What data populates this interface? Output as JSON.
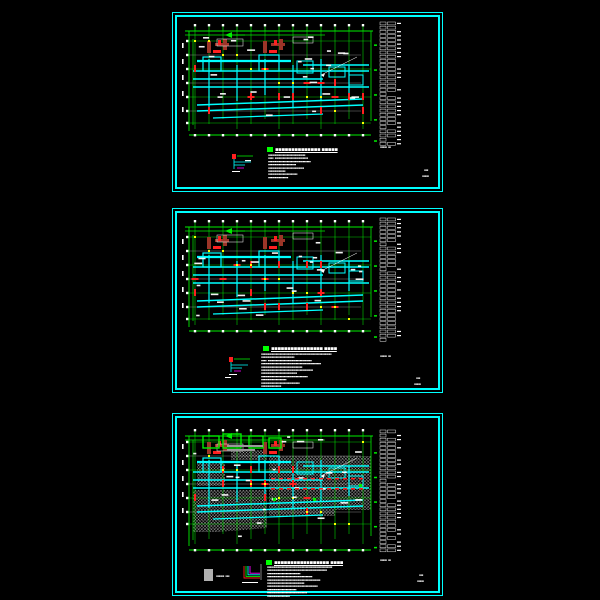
{
  "app": {
    "background": "#000000",
    "description": "cad-drawing-preview-three-sheets"
  },
  "colors": {
    "border": "#00ffff",
    "grid_green": "#00ee00",
    "beam_cyan": "#00ffff",
    "column_red": "#ff2020",
    "column_dark": "#9c3528",
    "node_yellow": "#ffff00",
    "text_white": "#ffffff",
    "gray": "#9a9a9a",
    "magenta": "#ff00ff",
    "hatch": "#cccccc",
    "legend_gray": "#b0b0b0"
  },
  "sheets": [
    {
      "name": "sheet-1",
      "title": "▪▪▪▪▪▪▪▪▪▪▪▪▪▪ ▪▪▪▪▪",
      "notes": [
        "▪▪▪▪▪▪▪▪▪▪▪▪▪▪▪▪▪▪▪▪▪▪▪▪▪▪▪▪",
        "▪▪▪▪ ▪▪▪▪▪▪▪▪▪▪▪▪▪▪▪▪▪▪▪▪▪▪▪▪▪",
        "▪▪▪▪▪▪▪▪▪▪▪▪▪▪▪▪▪▪▪▪▪▪▪▪▪▪▪▪▪▪▪▪",
        "▪▪▪▪▪▪▪▪▪▪▪▪▪▪▪▪▪▪▪▪▪",
        "▪▪▪▪▪▪▪▪▪▪▪▪▪▪▪▪▪▪▪▪▪▪▪▪▪▪▪",
        "▪▪▪▪▪▪▪▪▪▪▪▪▪",
        "▪▪▪▪▪▪▪▪▪▪▪▪▪▪▪▪▪▪▪▪▪▪",
        "▪▪▪▪▪▪▪▪▪▪▪▪▪▪▪"
      ],
      "table_caption": "▪▪▪▪▪ ▪▪",
      "titleblock": {
        "line1": "▪▪▪",
        "line2": "▪▪▪▪▪"
      },
      "table_rows": 30
    },
    {
      "name": "sheet-2",
      "title": "▪▪▪▪▪▪▪▪▪▪▪▪▪▪▪▪ ▪▪▪▪",
      "notes": [
        "▪▪▪▪▪▪▪▪▪▪▪▪▪▪▪▪▪▪▪▪▪▪▪▪▪▪▪▪▪▪▪▪▪▪▪▪▪▪▪▪▪▪▪▪▪▪▪▪▪▪▪▪▪",
        "▪▪▪▪▪▪▪▪▪▪▪▪▪▪▪▪▪▪▪▪▪▪▪▪▪",
        "▪▪▪▪ ▪▪▪▪▪▪▪▪▪▪▪▪▪▪▪▪▪▪▪▪▪▪▪▪▪▪▪▪▪▪▪▪▪",
        "▪▪▪▪▪▪▪▪▪▪▪▪▪▪▪▪▪▪▪▪▪▪▪▪▪▪▪▪▪▪▪▪▪▪▪▪▪▪▪▪▪▪▪▪▪",
        "▪▪▪▪▪▪▪▪▪▪▪▪▪▪▪▪▪▪▪▪▪▪▪▪▪▪▪▪▪▪▪",
        "▪▪▪▪▪▪▪▪▪▪▪▪▪▪▪▪▪▪▪▪▪▪▪▪▪▪▪▪▪▪▪▪▪▪▪▪▪▪▪",
        "▪▪▪▪▪▪▪▪▪▪▪▪▪▪▪▪▪▪▪▪▪▪▪▪▪▪▪",
        "▪▪▪▪▪▪▪▪▪▪▪▪▪▪▪▪▪▪▪▪▪▪▪▪▪▪▪▪▪▪▪▪▪▪▪",
        "▪▪▪▪▪▪▪▪▪▪▪▪▪▪▪▪▪▪▪",
        "▪▪▪▪▪▪▪▪▪▪▪▪▪▪▪▪▪▪▪▪▪▪▪▪▪▪▪▪▪",
        "▪▪▪▪▪▪▪▪▪▪▪▪▪▪▪"
      ],
      "table_caption": "▪▪▪▪▪ ▪▪",
      "titleblock": {
        "line1": "▪▪▪",
        "line2": "▪▪▪▪▪"
      },
      "table_rows": 30
    },
    {
      "name": "sheet-3",
      "title": "▪▪▪▪▪▪▪▪▪▪▪▪▪▪▪▪▪ ▪▪▪▪",
      "notes": [
        "▪▪▪▪▪▪▪▪▪▪▪▪▪▪▪▪▪▪▪▪▪▪▪▪▪▪▪▪▪▪▪▪▪▪▪▪▪▪▪▪▪▪▪▪▪▪▪▪▪",
        "▪▪▪▪▪▪▪▪▪▪▪▪▪▪▪▪▪▪▪▪▪▪▪▪▪▪▪▪▪▪▪▪▪▪▪▪▪▪▪▪▪▪▪▪▪",
        "▪▪▪▪▪▪▪▪▪▪▪▪▪▪▪▪▪▪▪▪▪▪▪▪▪",
        "▪▪▪▪▪▪▪▪▪▪▪▪▪▪▪▪▪▪▪▪▪▪▪▪▪▪▪▪▪▪▪▪▪▪",
        "▪▪▪▪▪▪▪▪▪▪▪▪▪▪▪▪▪▪▪▪▪▪▪▪▪▪▪▪▪▪▪▪▪▪▪▪▪▪▪▪",
        "▪▪▪▪▪▪▪▪▪▪▪▪▪▪▪▪▪▪▪▪▪▪▪▪▪▪▪▪",
        "▪▪▪▪▪▪▪▪▪▪▪▪▪▪▪▪▪▪▪▪▪▪▪▪▪▪▪▪▪▪▪▪▪▪▪▪▪▪",
        "▪▪▪▪▪▪▪▪▪▪▪▪▪▪▪▪▪▪▪▪▪▪",
        "▪▪▪▪▪▪▪▪▪▪▪▪▪▪▪▪▪▪▪▪▪▪▪▪▪▪▪▪▪▪",
        "▪▪▪▪▪▪▪▪▪▪▪▪▪▪▪▪▪"
      ],
      "legend_label": "▪▪▪▪▪▪ ▪▪▪",
      "table_caption": "▪▪▪▪▪ ▪▪",
      "titleblock": {
        "line1": "▪▪▪",
        "line2": "▪▪▪▪▪"
      },
      "table_rows": 30
    }
  ]
}
